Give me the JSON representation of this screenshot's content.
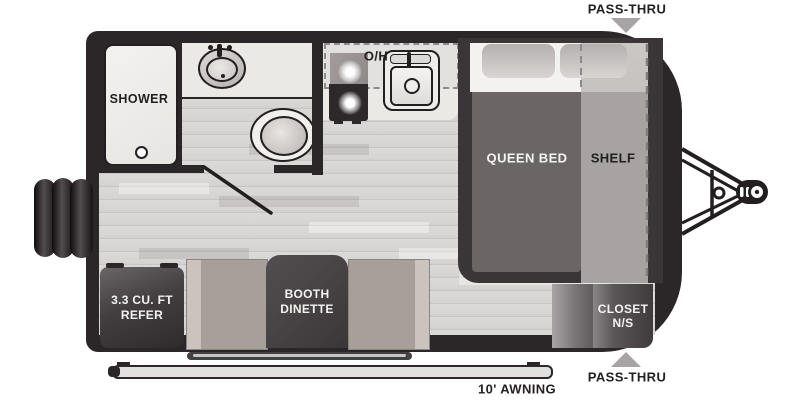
{
  "labels": {
    "pass_thru_top": "PASS-THRU",
    "pass_thru_bottom": "PASS-THRU",
    "awning": "10' AWNING",
    "shower": "SHOWER",
    "overhead_cabinet": "O/H",
    "queen_bed": "QUEEN BED",
    "shelf": "SHELF",
    "refer_line1": "3.3 CU. FT",
    "refer_line2": "REFER",
    "dinette_line1": "BOOTH",
    "dinette_line2": "DINETTE",
    "closet_line1": "CLOSET",
    "closet_line2": "N/S"
  },
  "colors": {
    "body_dark": "#2b2728",
    "floor": "#d8d6d4",
    "counter": "#ebe9e6",
    "bed_platform": "#3a3637",
    "blanket": "#6b6566",
    "shelf": "#a8a2a3",
    "bench": "#a7a099",
    "table_dark": "#474243",
    "label_dark": "#231f20",
    "label_light": "#f4f3f2",
    "arrow_gray": "#a8a4a5"
  }
}
